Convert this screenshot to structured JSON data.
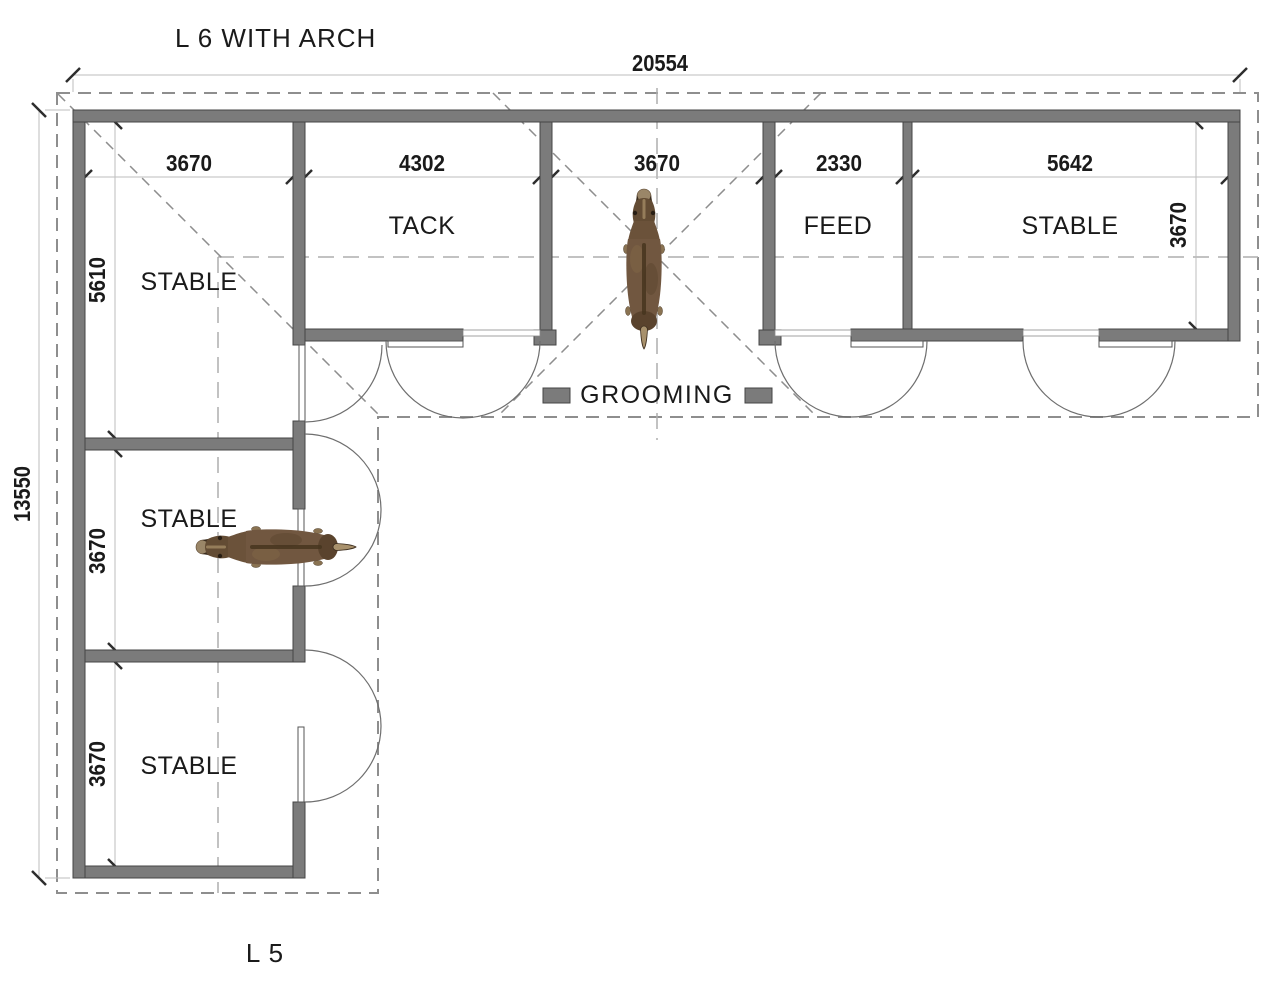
{
  "title": "L 6 WITH ARCH",
  "footer": "L 5",
  "dimensions": {
    "overall_width": "20554",
    "overall_height": "13550",
    "top_row": [
      "3670",
      "4302",
      "3670",
      "2330",
      "5642"
    ],
    "right_depth": "3670",
    "left_column": [
      "5610",
      "3670",
      "3670"
    ]
  },
  "rooms": {
    "corner_stable": "STABLE",
    "tack": "TACK",
    "grooming": "GROOMING",
    "feed": "FEED",
    "right_stable": "STABLE",
    "middle_stable": "STABLE",
    "bottom_stable": "STABLE"
  },
  "icons": {
    "horse_grooming": "horse-top-view",
    "horse_stable": "horse-top-view"
  },
  "colors": {
    "wall": "#7b7b7b",
    "wall_edge": "#454545",
    "dashed_line": "#8e8e8e",
    "dim_line": "#bdbdbd",
    "text": "#1a1a1a",
    "horse_body": "#715740"
  }
}
